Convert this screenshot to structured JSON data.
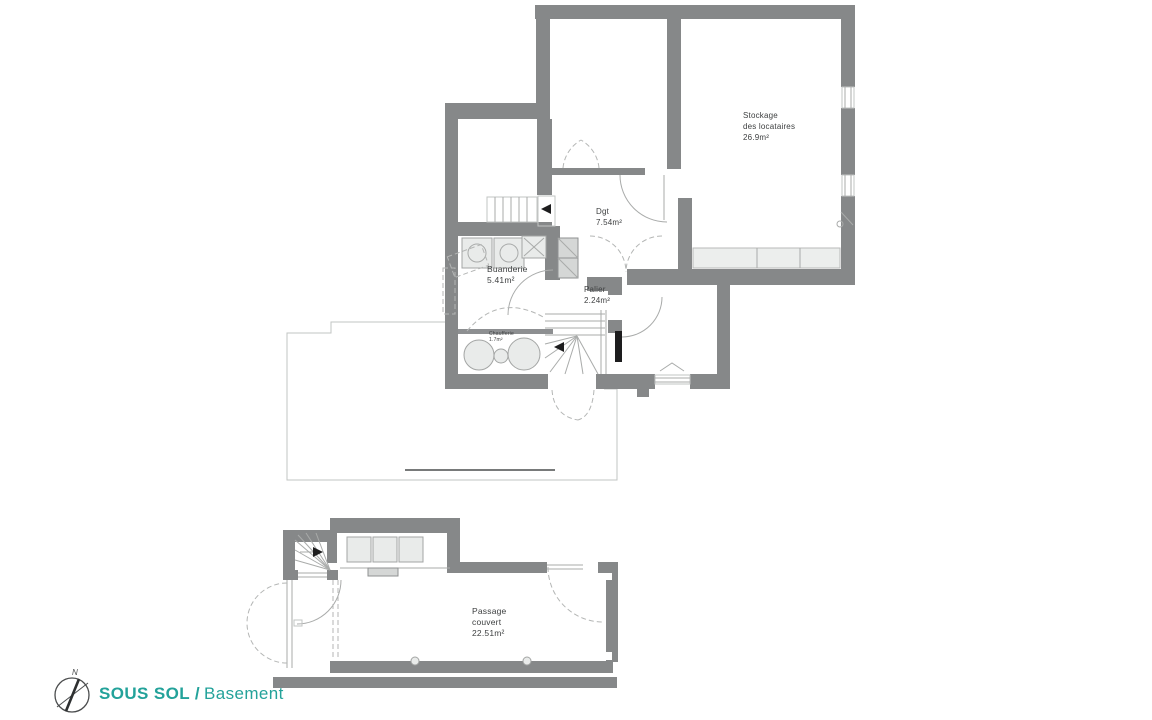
{
  "colors": {
    "wall": "#868889",
    "furniture_fill": "#e9ebea",
    "accent_teal": "#23a29a",
    "thin_line": "#a9abaa",
    "label_text": "#3e4041"
  },
  "title": {
    "primary": "SOUS SOL /",
    "secondary": "Basement"
  },
  "compass": {
    "north_label": "N"
  },
  "floor_plan": {
    "basement_rooms": {
      "stockage": {
        "name_line1": "Stockage",
        "name_line2": "des locataires",
        "area": "26.9m²"
      },
      "dgt": {
        "name": "Dgt",
        "area": "7.54m²"
      },
      "buanderie": {
        "name": "Buanderie",
        "area": "5.41m²"
      },
      "palier": {
        "name": "Palier",
        "area": "2.24m²"
      },
      "chaufferie": {
        "name": "Chaufferie",
        "area": "1.7m²"
      },
      "passage": {
        "name_line1": "Passage",
        "name_line2": "couvert",
        "area": "22.51m²"
      }
    }
  }
}
